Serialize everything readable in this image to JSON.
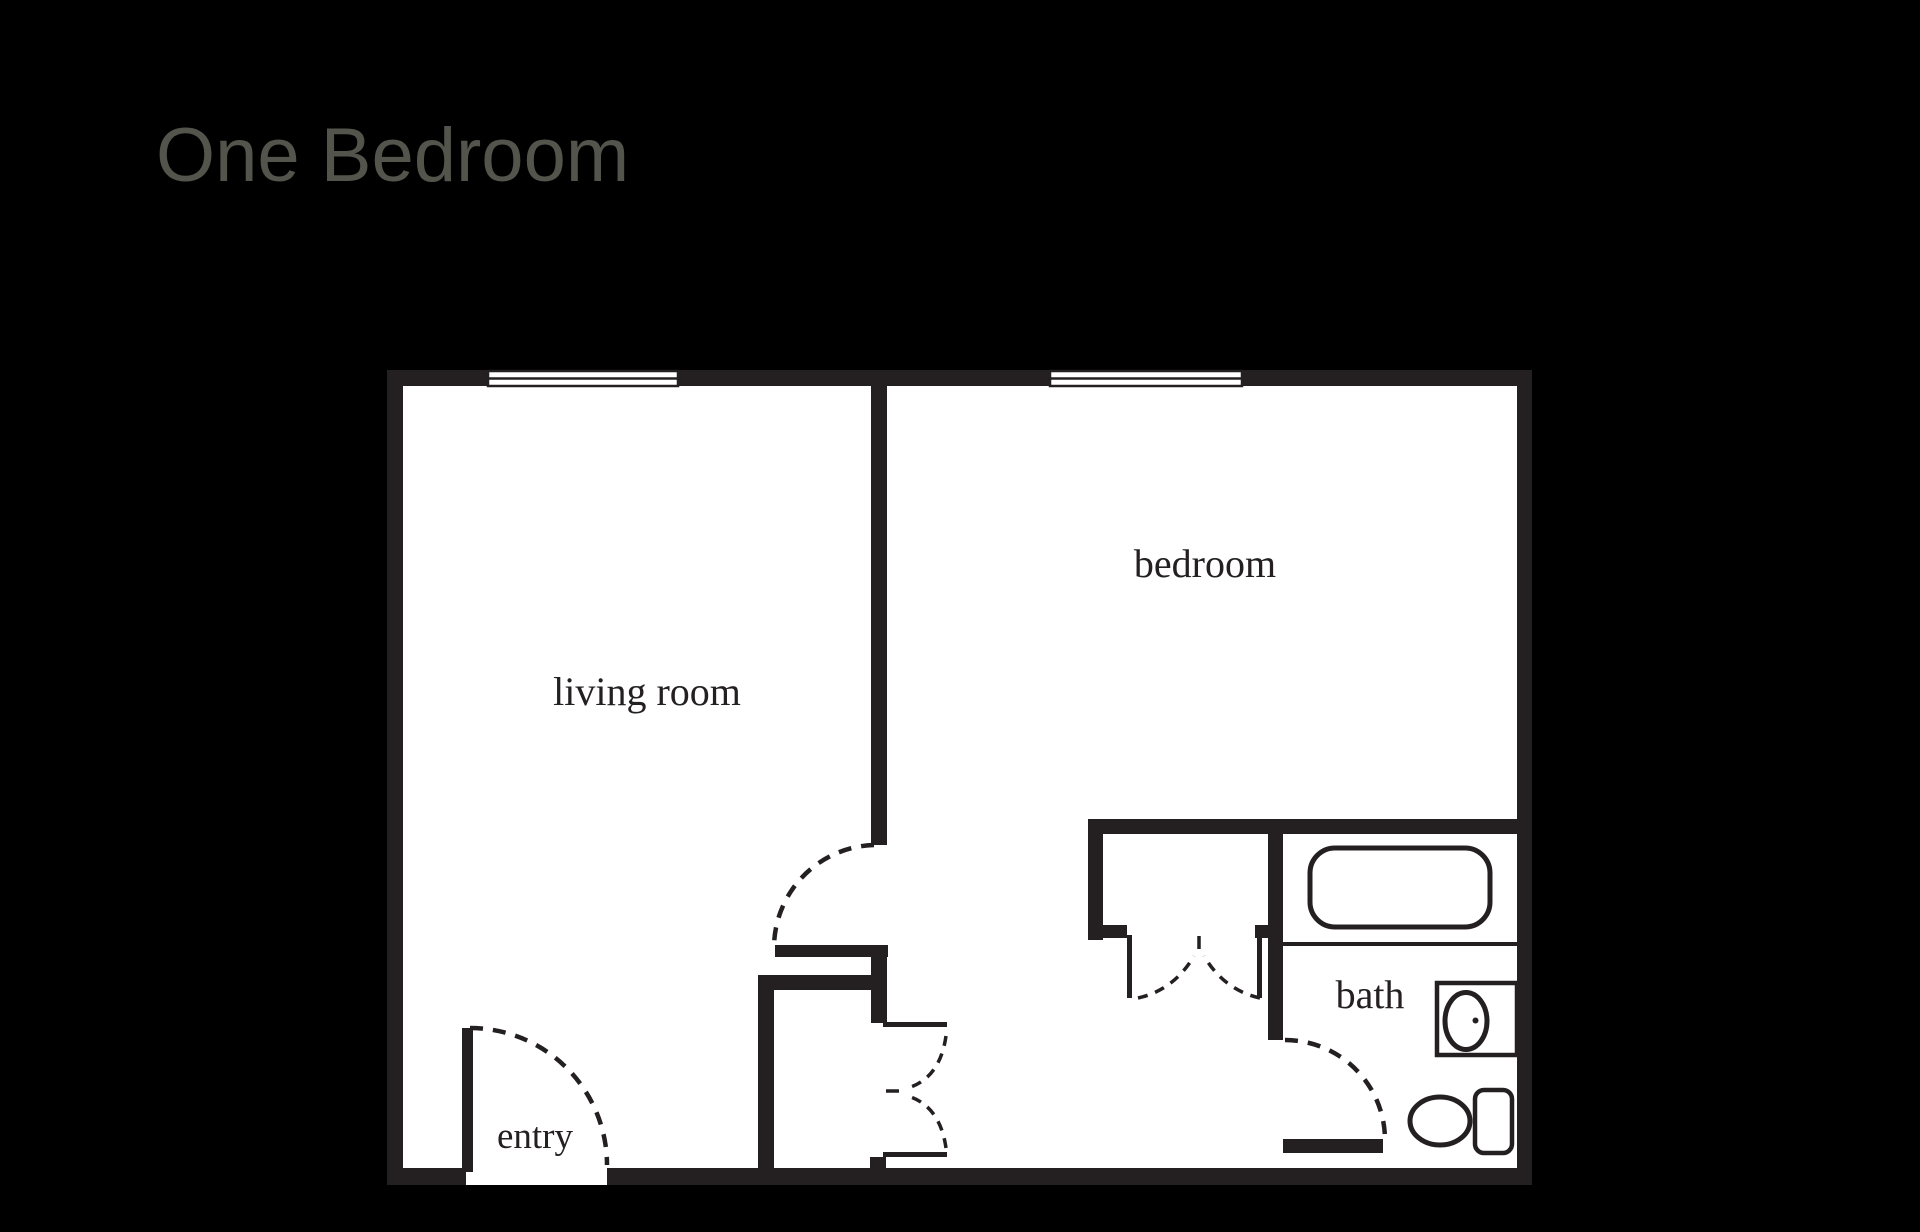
{
  "title": {
    "text": "One Bedroom",
    "color": "#53544b"
  },
  "floorplan": {
    "background_color": "#000000",
    "wall_color": "#242021",
    "floor_color": "#ffffff",
    "labels": {
      "living_room": "living room",
      "bedroom": "bedroom",
      "bath": "bath",
      "entry": "entry"
    },
    "fixtures": [
      "living-room-window",
      "bedroom-window",
      "entry-door-swing",
      "hall-door-swing",
      "bath-door-swing",
      "hall-closet-double-doors",
      "bedroom-closet-double-doors",
      "bathtub",
      "sink-vanity",
      "toilet"
    ]
  }
}
